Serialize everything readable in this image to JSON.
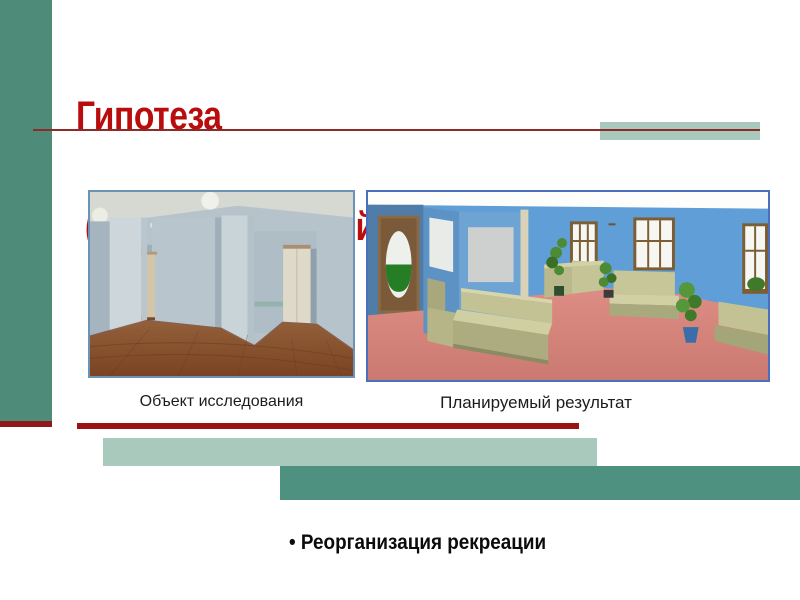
{
  "slide": {
    "title": {
      "line1": "Гипотеза",
      "line2": " (предполагаемый ответ на вопрос).",
      "color": "#b90d0d"
    },
    "captions": {
      "left": "Объект исследования",
      "right": "Планируемый результат"
    },
    "bullet": {
      "marker": "•",
      "label": "Реорганизация рекреации"
    },
    "accent_colors": {
      "teal": "#4e8b79",
      "teal_light": "#a9c9bd",
      "teal_dark": "#4f9180",
      "red_bar": "#9b1414",
      "red_accent": "#8e1a1a",
      "rule_red": "#8e2a28",
      "photo_border": "#6b93b5",
      "render_border": "#4a6fbd"
    }
  }
}
